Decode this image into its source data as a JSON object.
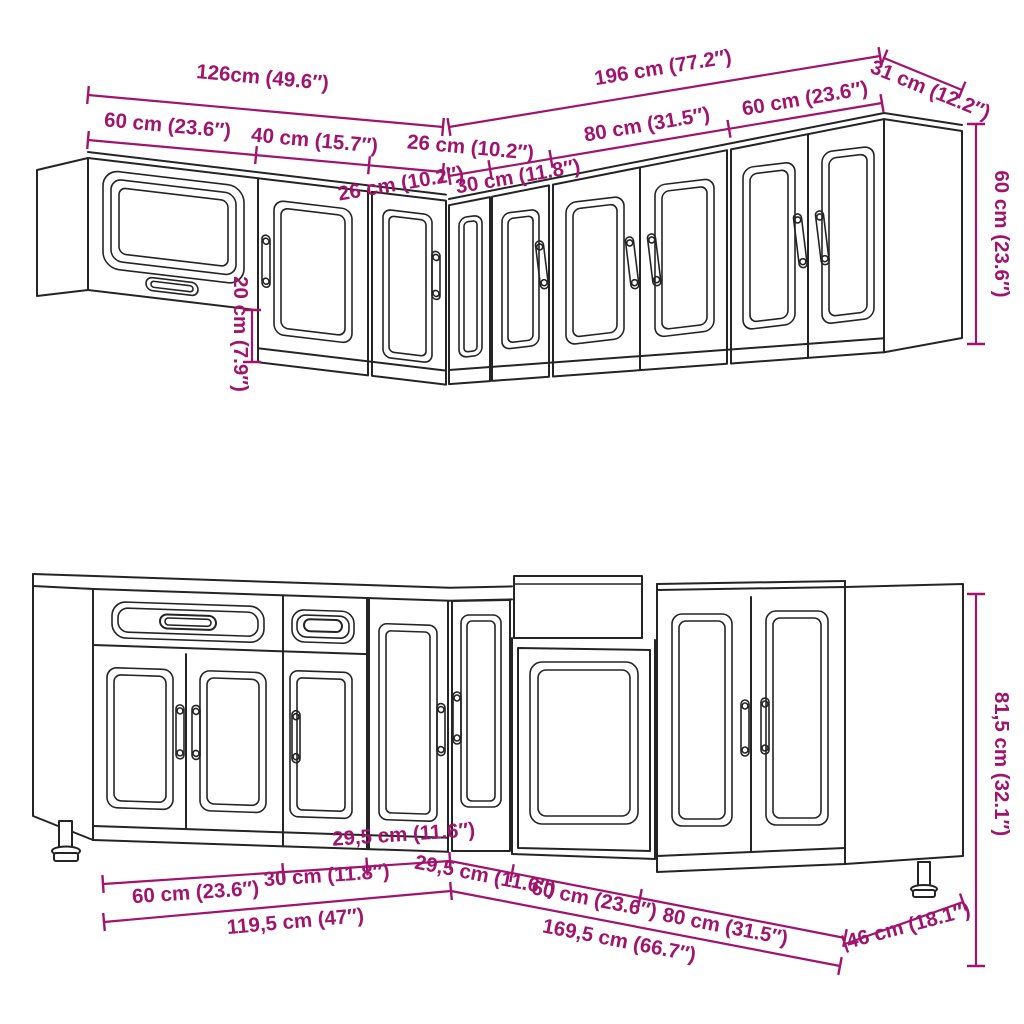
{
  "colors": {
    "dimension": "#A0146E",
    "outline": "#242424",
    "background": "#FFFFFF"
  },
  "dims": {
    "upper": {
      "total_left": "126cm (49.6″)",
      "total_right": "196 cm (77.2″)",
      "side_depth": "31 cm (12.2″)",
      "seg_60_left": "60 cm (23.6″)",
      "seg_40": "40 cm (15.7″)",
      "seg_26_left": "26 cm (10.2″)",
      "seg_26_right": "26 cm (10.2″)",
      "seg_30": "30 cm (11.8″)",
      "seg_80": "80 cm (31.5″)",
      "seg_60_right": "60 cm (23.6″)",
      "height": "60 cm (23.6″)",
      "height_offset": "20 cm (7.9″)"
    },
    "lower": {
      "seg_60_left": "60 cm (23.6″)",
      "seg_30": "30 cm (11.8″)",
      "seg_295_left": "29,5 cm (11.6″)",
      "seg_295_right": "29,5 cm (11.6″)",
      "seg_60_right": "60 cm (23.6″)",
      "seg_80": "80 cm (31.5″)",
      "total_left": "119,5 cm (47″)",
      "total_right": "169,5 cm (66.7″)",
      "side_depth": "46 cm (18.1″)",
      "height": "81,5 cm (32.1″)"
    }
  }
}
